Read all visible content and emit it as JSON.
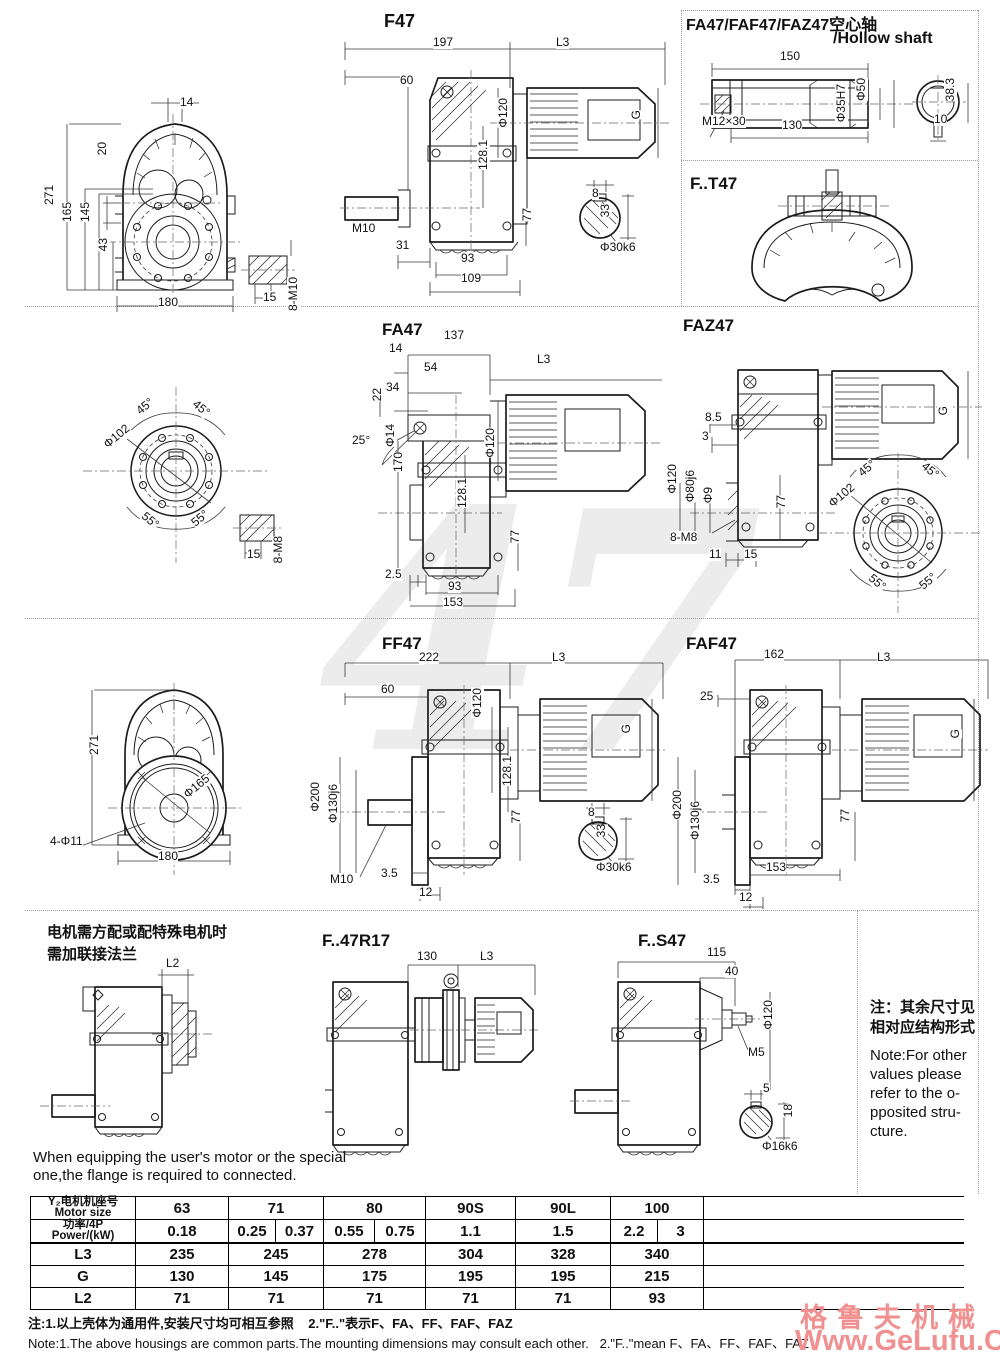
{
  "watermark": {
    "big": "47"
  },
  "brand": {
    "cn": "格鲁夫机械",
    "url": "Www.GeLufu.Com"
  },
  "f47": {
    "title": "F47",
    "front": {
      "w14": "14",
      "h20": "20",
      "h271": "271",
      "h165": "165",
      "h145": "145",
      "h43": "43",
      "w180": "180",
      "w15": "15",
      "tap": "8-M10"
    },
    "side": {
      "w197": "197",
      "l3": "L3",
      "w60": "60",
      "phi120": "Φ120",
      "h128": "128.1",
      "g": "G",
      "m10": "M10",
      "w31": "31",
      "w93": "93",
      "w109": "109",
      "h77": "77",
      "key_w": "8",
      "key_h": "33",
      "shaft": "Φ30k6"
    }
  },
  "hollow": {
    "title_cn": "FA47/FAF47/FAZ47空心轴",
    "title_en": "/Hollow shaft",
    "w150": "150",
    "thread": "M12×30",
    "w130": "130",
    "bore": "Φ35H7",
    "phi50": "Φ50",
    "h383": "38.3",
    "w10": "10"
  },
  "ft47": {
    "title": "F..T47"
  },
  "fa47": {
    "title": "FA47",
    "side": {
      "w137": "137",
      "w14": "14",
      "w54": "54",
      "w34": "34",
      "h22": "22",
      "a25": "25°",
      "phi14": "Φ14",
      "l3": "L3",
      "phi120": "Φ120",
      "h170": "170",
      "h128": "128.1",
      "h77": "77",
      "w25": "2.5",
      "w93": "93",
      "w153": "153"
    },
    "flange": {
      "a45l": "45°",
      "a45r": "45°",
      "phi102": "Φ102",
      "a55l": "55°",
      "a55r": "55°",
      "w15": "15",
      "tap": "8-M8"
    }
  },
  "faz47": {
    "title": "FAZ47",
    "side": {
      "w85": "8.5",
      "w3": "3",
      "phi120": "Φ120",
      "phi80": "Φ80j6",
      "phi9": "Φ9",
      "h77": "77",
      "tap": "8-M8",
      "w11": "11",
      "w15": "15",
      "g": "G"
    },
    "flange": {
      "a45l": "45°",
      "a45r": "45°",
      "phi102": "Φ102",
      "a55l": "55°",
      "a55r": "55°"
    }
  },
  "ff47": {
    "title": "FF47",
    "front": {
      "h271": "271",
      "phi165": "Φ165",
      "holes": "4-Φ11",
      "w180": "180"
    },
    "side": {
      "w222": "222",
      "l3": "L3",
      "w60": "60",
      "phi120": "Φ120",
      "g": "G",
      "h128": "128.1",
      "phi200": "Φ200",
      "phi130": "Φ130j6",
      "h77": "77",
      "m10": "M10",
      "w35": "3.5",
      "w12": "12",
      "key_w": "8",
      "key_h": "33",
      "shaft": "Φ30k6"
    }
  },
  "faf47": {
    "title": "FAF47",
    "side": {
      "w162": "162",
      "l3": "L3",
      "w25": "25",
      "g": "G",
      "phi200": "Φ200",
      "phi130": "Φ130j6",
      "h77": "77",
      "w153": "153",
      "w35": "3.5",
      "w12": "12"
    }
  },
  "flange_note": {
    "cn1": "电机需方配或配特殊电机时",
    "cn2": "需加联接法兰",
    "l2": "L2",
    "en1": "When equipping the user's motor or the special",
    "en2": "one,the flange is required to connected."
  },
  "fr17": {
    "title": "F..47R17",
    "w130": "130",
    "l3": "L3"
  },
  "fs47": {
    "title": "F..S47",
    "w115": "115",
    "w40": "40",
    "phi120": "Φ120",
    "m5": "M5",
    "key_w": "5",
    "key_h": "18",
    "shaft": "Φ16k6"
  },
  "side_note": {
    "cn1": "注：其余尺寸见",
    "cn2": "相对应结构形式",
    "en1": "Note:For other",
    "en2": "values please",
    "en3": "refer to the o-",
    "en4": "pposited stru-",
    "en5": "cture."
  },
  "table": {
    "header": {
      "motor_cn": "Y₂电机机座号",
      "motor_en": "Motor size",
      "power_cn": "功率/4P",
      "power_en": "Power/(kW)",
      "l3": "L3",
      "g": "G",
      "l2": "L2"
    },
    "motor_sizes": [
      "63",
      "71",
      "80",
      "90S",
      "90L",
      "100"
    ],
    "power": [
      "0.18",
      "0.25",
      "0.37",
      "0.55",
      "0.75",
      "1.1",
      "1.5",
      "2.2",
      "3"
    ],
    "l3": [
      "235",
      "245",
      "278",
      "304",
      "328",
      "340"
    ],
    "g": [
      "130",
      "145",
      "175",
      "195",
      "195",
      "215"
    ],
    "l2": [
      "71",
      "71",
      "71",
      "71",
      "71",
      "93"
    ]
  },
  "footnotes": {
    "cn": "注:1.以上壳体为通用件,安装尺寸均可相互参照    2.\"F..\"表示F、FA、FF、FAF、FAZ",
    "en": "Note:1.The above housings are common parts.The mounting dimensions may consult each other.   2.\"F..\"mean F、FA、FF、FAF、FAZ"
  }
}
